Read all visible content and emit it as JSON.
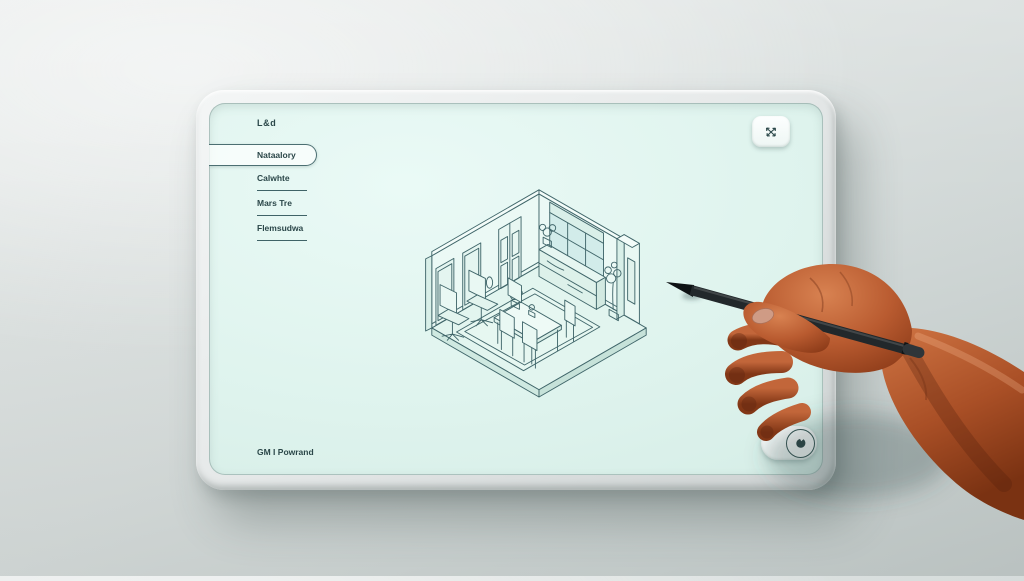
{
  "tablet": {
    "logo": "L&d",
    "nav": [
      {
        "label": "Nataalory",
        "selected": true
      },
      {
        "label": "Calwhte",
        "selected": false
      },
      {
        "label": "Mars Tre",
        "selected": false
      },
      {
        "label": "Flemsudwa",
        "selected": false
      }
    ],
    "footer_label": "GM I Powrand",
    "icons": {
      "expand": "expand-arrows-icon",
      "pen_tool": "ink-drop-icon"
    }
  },
  "drawing": {
    "type": "isometric-room-line-sketch",
    "elements": [
      "floor slab",
      "left wall with two framed doors and paneled double door",
      "wall sconce",
      "window wall with valance and mullioned glass",
      "sideboard cabinet under window with potted plant",
      "free-standing partition column with leaning mirror and tall plant",
      "area rug with double border",
      "dining table with potted plants and four chairs",
      "two office chairs"
    ]
  },
  "scene": {
    "hand": "right hand holding black stylus, tip touching screen"
  },
  "colors": {
    "wall_bg": "#d8dedd",
    "bezel": "#e9ebeb",
    "screen_bg": "#ddf2ec",
    "line_art": "#40666a",
    "ui_text": "#2b4749",
    "skin": "#b4552c",
    "stylus": "#22282b"
  }
}
